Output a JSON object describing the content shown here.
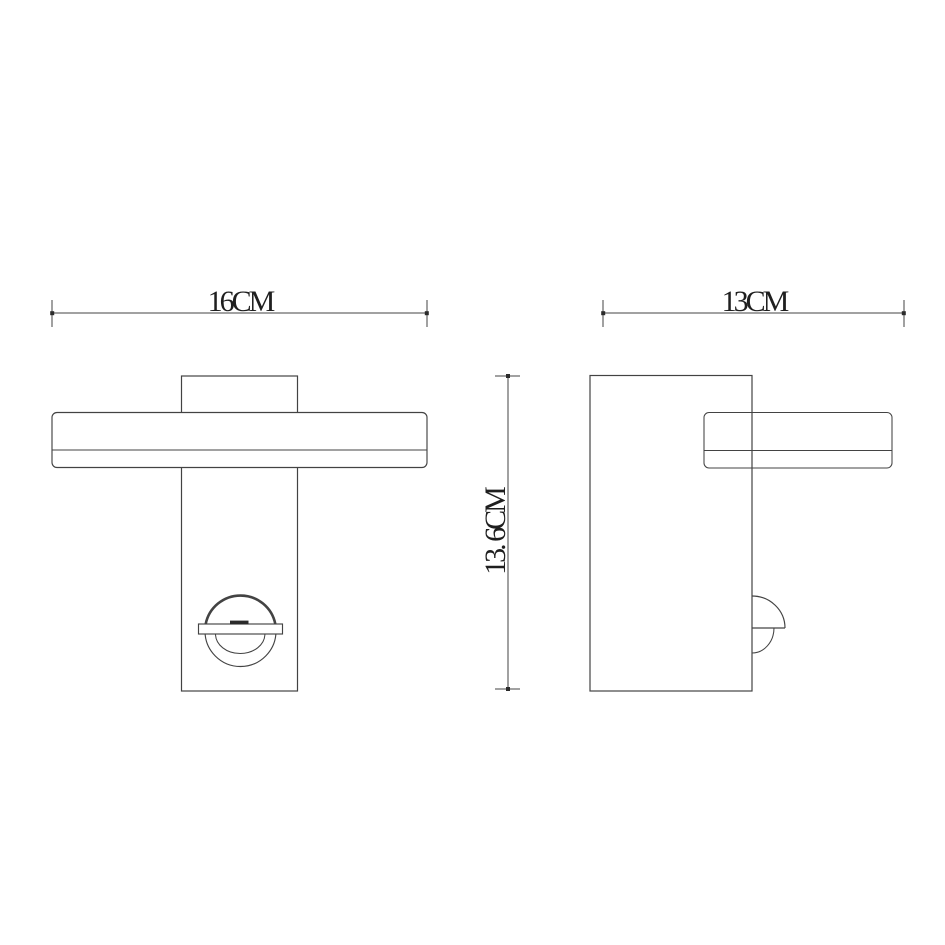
{
  "page": {
    "background_color": "#ffffff"
  },
  "drawing": {
    "type": "technical-dimension-drawing",
    "subject": "wall-lamp-two-views",
    "stroke_color": "#434343",
    "text_color": "#1f1f1f",
    "accent_dark": "#2b2b2b",
    "dimensions": {
      "front_width_label": "16CM",
      "side_depth_label": "13CM",
      "height_label": "13. 6CM"
    }
  }
}
